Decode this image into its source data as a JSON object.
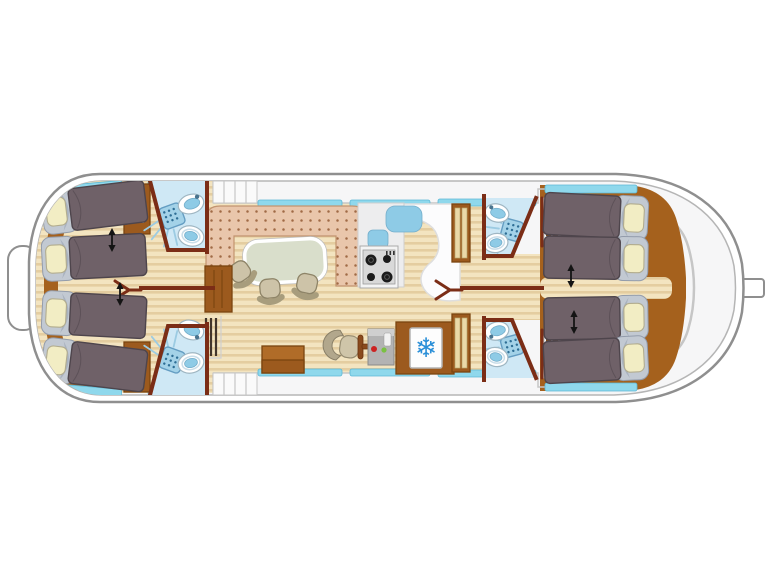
{
  "diagram": {
    "title": "houseboat-deck-floorplan",
    "vessel_type": "canal houseboat, top-down interior plan",
    "orientation": {
      "bow": "right",
      "stern": "left"
    },
    "stern_section": {
      "cabins": 2,
      "beds_per_cabin": 2,
      "ensuite_bathrooms": 2,
      "wardrobes": 2,
      "convertible_bed_arrows": 2
    },
    "bow_section": {
      "cabins": 2,
      "beds": 4,
      "ensuite_bathrooms": 2,
      "wardrobes": 2,
      "shelf_units": 2,
      "convertible_bed_arrows": 2
    },
    "salon": {
      "sofa": "U-shaped dinette sofa",
      "table": 1,
      "chairs": 3,
      "sideboard": 1,
      "storage_chest": 1
    },
    "galley": {
      "sink_basins": 2,
      "stove_burners": 4,
      "refrigerator": 1
    },
    "helm": {
      "seat": 1,
      "steering_wheel": 1,
      "control_console": 1,
      "indicator_lights": 2
    },
    "bathroom_fixtures": [
      "shower",
      "washbasin",
      "toilet"
    ],
    "access": {
      "side_entry_steps": 2
    },
    "totals": {
      "beds": 8,
      "bathrooms": 4,
      "showers": 4,
      "toilets": 4,
      "washbasins": 4
    }
  },
  "icons": {
    "snowflake_glyph": "❄"
  },
  "colors": {
    "hull_stroke": "#8f8f8f",
    "hull_line": "#b5b5b5",
    "deck": "#f6f6f7",
    "wood_base": "#f3e4c0",
    "wood_stripe": "#e4cda0",
    "cabin_floor": "#a5611d",
    "wall": "#7b2d16",
    "window": "#8fd8ec",
    "window_stroke": "#5cb8d6",
    "bath": "#cfe8f5",
    "fixture": "#8ecbe6",
    "mattress": "#6f6168",
    "bed_head": "#c2c9d2",
    "pillow": "#f2edc4",
    "sofa": "#e9c6ab",
    "sofa_dot": "#a06a46",
    "table": "#d9decb",
    "chair": "#cdc3a8",
    "cabinet": "#9c5a1e",
    "snowflake": "#2a8fd8",
    "console_red": "#cc2222",
    "console_green": "#7ac142"
  }
}
